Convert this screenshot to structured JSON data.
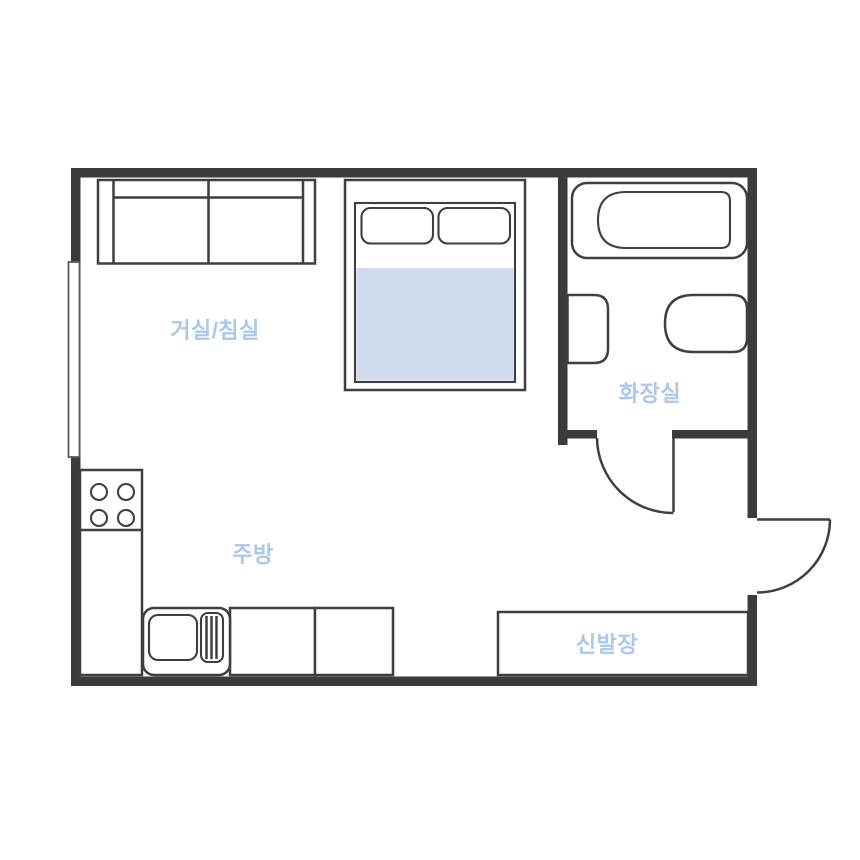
{
  "colors": {
    "wall": "#3b3b3b",
    "line": "#3f3f3f",
    "blanket": "#d0dcee",
    "label": "#a9c7ef",
    "bg": "#ffffff",
    "window-frame": "#5a5a5a"
  },
  "rooms": {
    "living_bedroom": {
      "label": "거실/침실"
    },
    "kitchen": {
      "label": "주방"
    },
    "bathroom": {
      "label": "화장실"
    },
    "entrance": {
      "shoe_cabinet_label": "신발장"
    }
  }
}
